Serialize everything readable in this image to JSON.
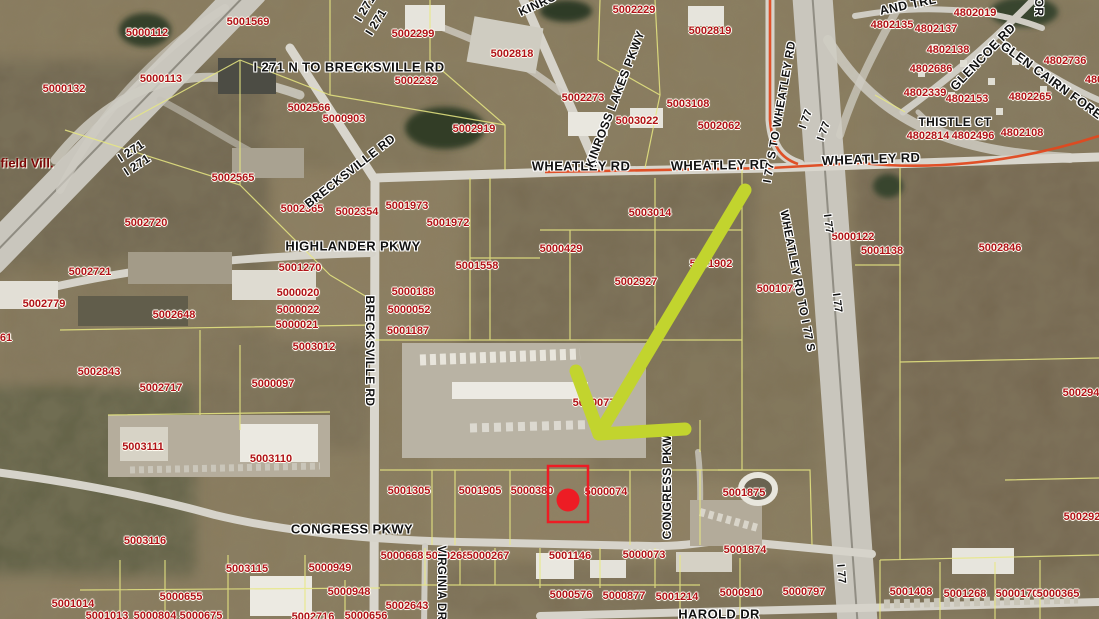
{
  "map": {
    "municipality_label": {
      "t": "field Vill.",
      "x": 27,
      "y": 163
    },
    "colors": {
      "parcel_text": "#b01218",
      "road_text": "#111111",
      "boundary_line": "#e8e882",
      "route_line": "#e0491f",
      "arrow": "#c2d42e",
      "marker": "#ed1c24"
    },
    "parcel_labels": [
      {
        "t": "5000112",
        "x": 147,
        "y": 33
      },
      {
        "t": "5001569",
        "x": 248,
        "y": 22
      },
      {
        "t": "5000113",
        "x": 161,
        "y": 79
      },
      {
        "t": "5000132",
        "x": 64,
        "y": 89
      },
      {
        "t": "5002299",
        "x": 413,
        "y": 34
      },
      {
        "t": "5002818",
        "x": 512,
        "y": 54
      },
      {
        "t": "5002232",
        "x": 416,
        "y": 81
      },
      {
        "t": "5002566",
        "x": 309,
        "y": 108
      },
      {
        "t": "5000903",
        "x": 344,
        "y": 119
      },
      {
        "t": "5002919",
        "x": 474,
        "y": 129
      },
      {
        "t": "5002229",
        "x": 634,
        "y": 10
      },
      {
        "t": "5002819",
        "x": 710,
        "y": 31
      },
      {
        "t": "5002273",
        "x": 583,
        "y": 98
      },
      {
        "t": "5003108",
        "x": 688,
        "y": 104
      },
      {
        "t": "5003022",
        "x": 637,
        "y": 121
      },
      {
        "t": "5002062",
        "x": 719,
        "y": 126
      },
      {
        "t": "4802019",
        "x": 975,
        "y": 13
      },
      {
        "t": "4802135",
        "x": 892,
        "y": 25
      },
      {
        "t": "4802137",
        "x": 936,
        "y": 29
      },
      {
        "t": "4802138",
        "x": 948,
        "y": 50
      },
      {
        "t": "4802686",
        "x": 931,
        "y": 69
      },
      {
        "t": "4802736",
        "x": 1065,
        "y": 61
      },
      {
        "t": "4802339",
        "x": 925,
        "y": 93
      },
      {
        "t": "4802153",
        "x": 967,
        "y": 99
      },
      {
        "t": "4802265",
        "x": 1030,
        "y": 97
      },
      {
        "t": "4802814",
        "x": 928,
        "y": 136
      },
      {
        "t": "4802496",
        "x": 973,
        "y": 136
      },
      {
        "t": "4802108",
        "x": 1022,
        "y": 133
      },
      {
        "t": "480",
        "x": 1094,
        "y": 80
      },
      {
        "t": "5002565",
        "x": 233,
        "y": 178
      },
      {
        "t": "5002720",
        "x": 146,
        "y": 223
      },
      {
        "t": "5002721",
        "x": 90,
        "y": 272
      },
      {
        "t": "5002779",
        "x": 44,
        "y": 304
      },
      {
        "t": "5002648",
        "x": 174,
        "y": 315
      },
      {
        "t": "5002365",
        "x": 302,
        "y": 209
      },
      {
        "t": "5002354",
        "x": 357,
        "y": 212
      },
      {
        "t": "5001973",
        "x": 407,
        "y": 206
      },
      {
        "t": "5001972",
        "x": 448,
        "y": 223
      },
      {
        "t": "5000429",
        "x": 561,
        "y": 249
      },
      {
        "t": "5001270",
        "x": 300,
        "y": 268
      },
      {
        "t": "5000020",
        "x": 298,
        "y": 293
      },
      {
        "t": "5000022",
        "x": 298,
        "y": 310
      },
      {
        "t": "5000021",
        "x": 297,
        "y": 325
      },
      {
        "t": "5003012",
        "x": 314,
        "y": 347
      },
      {
        "t": "5000188",
        "x": 413,
        "y": 292
      },
      {
        "t": "5000052",
        "x": 409,
        "y": 310
      },
      {
        "t": "5001187",
        "x": 408,
        "y": 331
      },
      {
        "t": "5001558",
        "x": 477,
        "y": 266
      },
      {
        "t": "5002927",
        "x": 636,
        "y": 282
      },
      {
        "t": "5001902",
        "x": 711,
        "y": 264
      },
      {
        "t": "5001074",
        "x": 778,
        "y": 289
      },
      {
        "t": "5000122",
        "x": 853,
        "y": 237
      },
      {
        "t": "5001138",
        "x": 882,
        "y": 251
      },
      {
        "t": "5002846",
        "x": 1000,
        "y": 248
      },
      {
        "t": "5003014",
        "x": 650,
        "y": 213
      },
      {
        "t": "5000077",
        "x": 594,
        "y": 403
      },
      {
        "t": "5002843",
        "x": 99,
        "y": 372
      },
      {
        "t": "5002717",
        "x": 161,
        "y": 388
      },
      {
        "t": "5000097",
        "x": 273,
        "y": 384
      },
      {
        "t": "5003111",
        "x": 143,
        "y": 447
      },
      {
        "t": "5003110",
        "x": 271,
        "y": 459
      },
      {
        "t": "61",
        "x": 6,
        "y": 338
      },
      {
        "t": "5003116",
        "x": 145,
        "y": 541
      },
      {
        "t": "5003115",
        "x": 247,
        "y": 569
      },
      {
        "t": "5000949",
        "x": 330,
        "y": 568
      },
      {
        "t": "5001014",
        "x": 73,
        "y": 604
      },
      {
        "t": "5000655",
        "x": 181,
        "y": 597
      },
      {
        "t": "5000948",
        "x": 349,
        "y": 592
      },
      {
        "t": "5002643",
        "x": 407,
        "y": 606
      },
      {
        "t": "5001013",
        "x": 107,
        "y": 616
      },
      {
        "t": "5000804",
        "x": 155,
        "y": 616
      },
      {
        "t": "5000675",
        "x": 201,
        "y": 616
      },
      {
        "t": "5002716",
        "x": 313,
        "y": 617
      },
      {
        "t": "5000656",
        "x": 366,
        "y": 616
      },
      {
        "t": "5001305",
        "x": 409,
        "y": 491
      },
      {
        "t": "5001905",
        "x": 480,
        "y": 491
      },
      {
        "t": "5000380",
        "x": 532,
        "y": 491
      },
      {
        "t": "5000074",
        "x": 606,
        "y": 492
      },
      {
        "t": "5000668",
        "x": 402,
        "y": 556
      },
      {
        "t": "5000268",
        "x": 447,
        "y": 556
      },
      {
        "t": "5000267",
        "x": 488,
        "y": 556
      },
      {
        "t": "5001146",
        "x": 570,
        "y": 556
      },
      {
        "t": "5000073",
        "x": 644,
        "y": 555
      },
      {
        "t": "5000576",
        "x": 571,
        "y": 595
      },
      {
        "t": "5000877",
        "x": 624,
        "y": 596
      },
      {
        "t": "5001214",
        "x": 677,
        "y": 597
      },
      {
        "t": "5001875",
        "x": 744,
        "y": 493
      },
      {
        "t": "5001874",
        "x": 745,
        "y": 550
      },
      {
        "t": "5000910",
        "x": 741,
        "y": 593
      },
      {
        "t": "5000797",
        "x": 804,
        "y": 592
      },
      {
        "t": "5001408",
        "x": 911,
        "y": 592
      },
      {
        "t": "5001268",
        "x": 965,
        "y": 594
      },
      {
        "t": "5000170",
        "x": 1017,
        "y": 594
      },
      {
        "t": "5000365",
        "x": 1058,
        "y": 594
      },
      {
        "t": "500294",
        "x": 1081,
        "y": 393
      },
      {
        "t": "500292",
        "x": 1082,
        "y": 517
      }
    ],
    "road_labels": [
      {
        "t": "I 271 N TO BRECKSVILLE RD",
        "x": 349,
        "y": 67,
        "r": 0,
        "s": 13
      },
      {
        "t": "I 271",
        "x": 365,
        "y": 8,
        "r": -58,
        "s": 12
      },
      {
        "t": "I 271",
        "x": 376,
        "y": 22,
        "r": -58,
        "s": 12
      },
      {
        "t": "I 271",
        "x": 131,
        "y": 151,
        "r": -33,
        "s": 12
      },
      {
        "t": "I 271",
        "x": 137,
        "y": 165,
        "r": -33,
        "s": 12
      },
      {
        "t": "BRECKSVILLE RD",
        "x": 350,
        "y": 171,
        "r": -38,
        "s": 12
      },
      {
        "t": "BRECKSVILLE RD",
        "x": 370,
        "y": 351,
        "r": 90,
        "s": 12
      },
      {
        "t": "WHEATLEY RD",
        "x": 581,
        "y": 166,
        "r": 0,
        "s": 13
      },
      {
        "t": "WHEATLEY RD",
        "x": 720,
        "y": 165,
        "r": -1,
        "s": 13
      },
      {
        "t": "WHEATLEY RD",
        "x": 871,
        "y": 159,
        "r": -2,
        "s": 13
      },
      {
        "t": "KINROSS LAKES PKWY",
        "x": 615,
        "y": 99,
        "r": -69,
        "s": 12
      },
      {
        "t": "KINROSS LAKES PKWY",
        "x": 585,
        "y": -18,
        "r": -25,
        "s": 12
      },
      {
        "t": "HIGHLANDER PKWY",
        "x": 353,
        "y": 246,
        "r": 0,
        "s": 13
      },
      {
        "t": "I 77 S TO WHEATLEY RD",
        "x": 780,
        "y": 112,
        "r": -80,
        "s": 11.5
      },
      {
        "t": "WHEATLEY RD TO I 77 S",
        "x": 797,
        "y": 281,
        "r": 79,
        "s": 11.5
      },
      {
        "t": "I 77",
        "x": 806,
        "y": 119,
        "r": -70,
        "s": 11
      },
      {
        "t": "I 77",
        "x": 824,
        "y": 131,
        "r": -70,
        "s": 11
      },
      {
        "t": "I 77",
        "x": 828,
        "y": 224,
        "r": 83,
        "s": 11
      },
      {
        "t": "I 77",
        "x": 837,
        "y": 303,
        "r": 83,
        "s": 11
      },
      {
        "t": "I 77",
        "x": 841,
        "y": 574,
        "r": 85,
        "s": 11
      },
      {
        "t": "CONGRESS PKWY",
        "x": 352,
        "y": 529,
        "r": 0,
        "s": 13
      },
      {
        "t": "CONGRESS PKW",
        "x": 667,
        "y": 487,
        "r": -90,
        "s": 12
      },
      {
        "t": "VIRGINIA DR",
        "x": 441,
        "y": 583,
        "r": 90,
        "s": 11.5
      },
      {
        "t": "HAROLD DR",
        "x": 719,
        "y": 614,
        "r": 0,
        "s": 13
      },
      {
        "t": "GLENCOE RD",
        "x": 983,
        "y": 57,
        "r": -46,
        "s": 12.5
      },
      {
        "t": "GLEN CAIRN FORES",
        "x": 1055,
        "y": 83,
        "r": 36,
        "s": 12.5
      },
      {
        "t": "THISTLE CT",
        "x": 955,
        "y": 122,
        "r": 0,
        "s": 12
      },
      {
        "t": "AND TRL",
        "x": 908,
        "y": 5,
        "r": -12,
        "s": 12.5
      },
      {
        "t": "OR",
        "x": 1039,
        "y": 7,
        "r": 90,
        "s": 12
      }
    ],
    "annotations": {
      "arrow": {
        "shaft": [
          745,
          190,
          599,
          434
        ],
        "barbs": [
          576,
          371,
          599,
          434,
          685,
          429
        ],
        "color": "#c2d42e",
        "width": 13
      },
      "marker": {
        "rect": [
          548,
          466,
          40,
          56
        ],
        "dot": [
          568,
          500,
          11.5
        ],
        "color": "#ed1c24",
        "stroke_width": 2.5
      }
    }
  }
}
